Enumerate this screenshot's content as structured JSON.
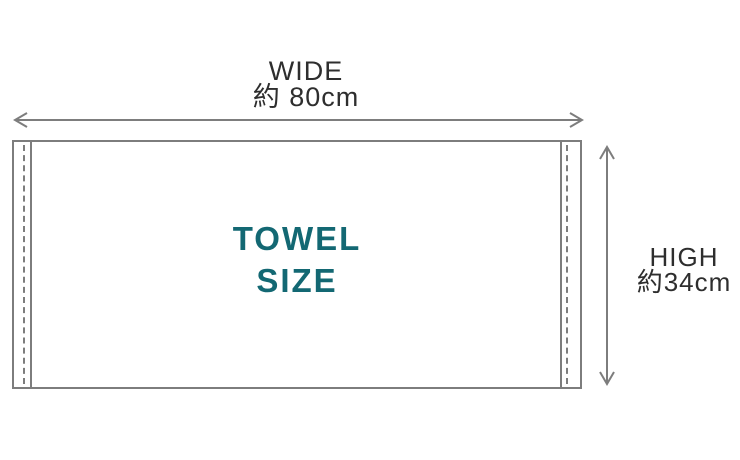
{
  "diagram": {
    "towel_label": {
      "line1": "TOWEL",
      "line2": "SIZE"
    },
    "width_dimension": {
      "name": "WIDE",
      "value": "約 80cm"
    },
    "height_dimension": {
      "name": "HIGH",
      "value": "約34cm"
    },
    "colors": {
      "background": "#ffffff",
      "outline": "#7d7d7d",
      "dimension_text": "#2e2e2e",
      "towel_label_text": "#136873"
    }
  }
}
